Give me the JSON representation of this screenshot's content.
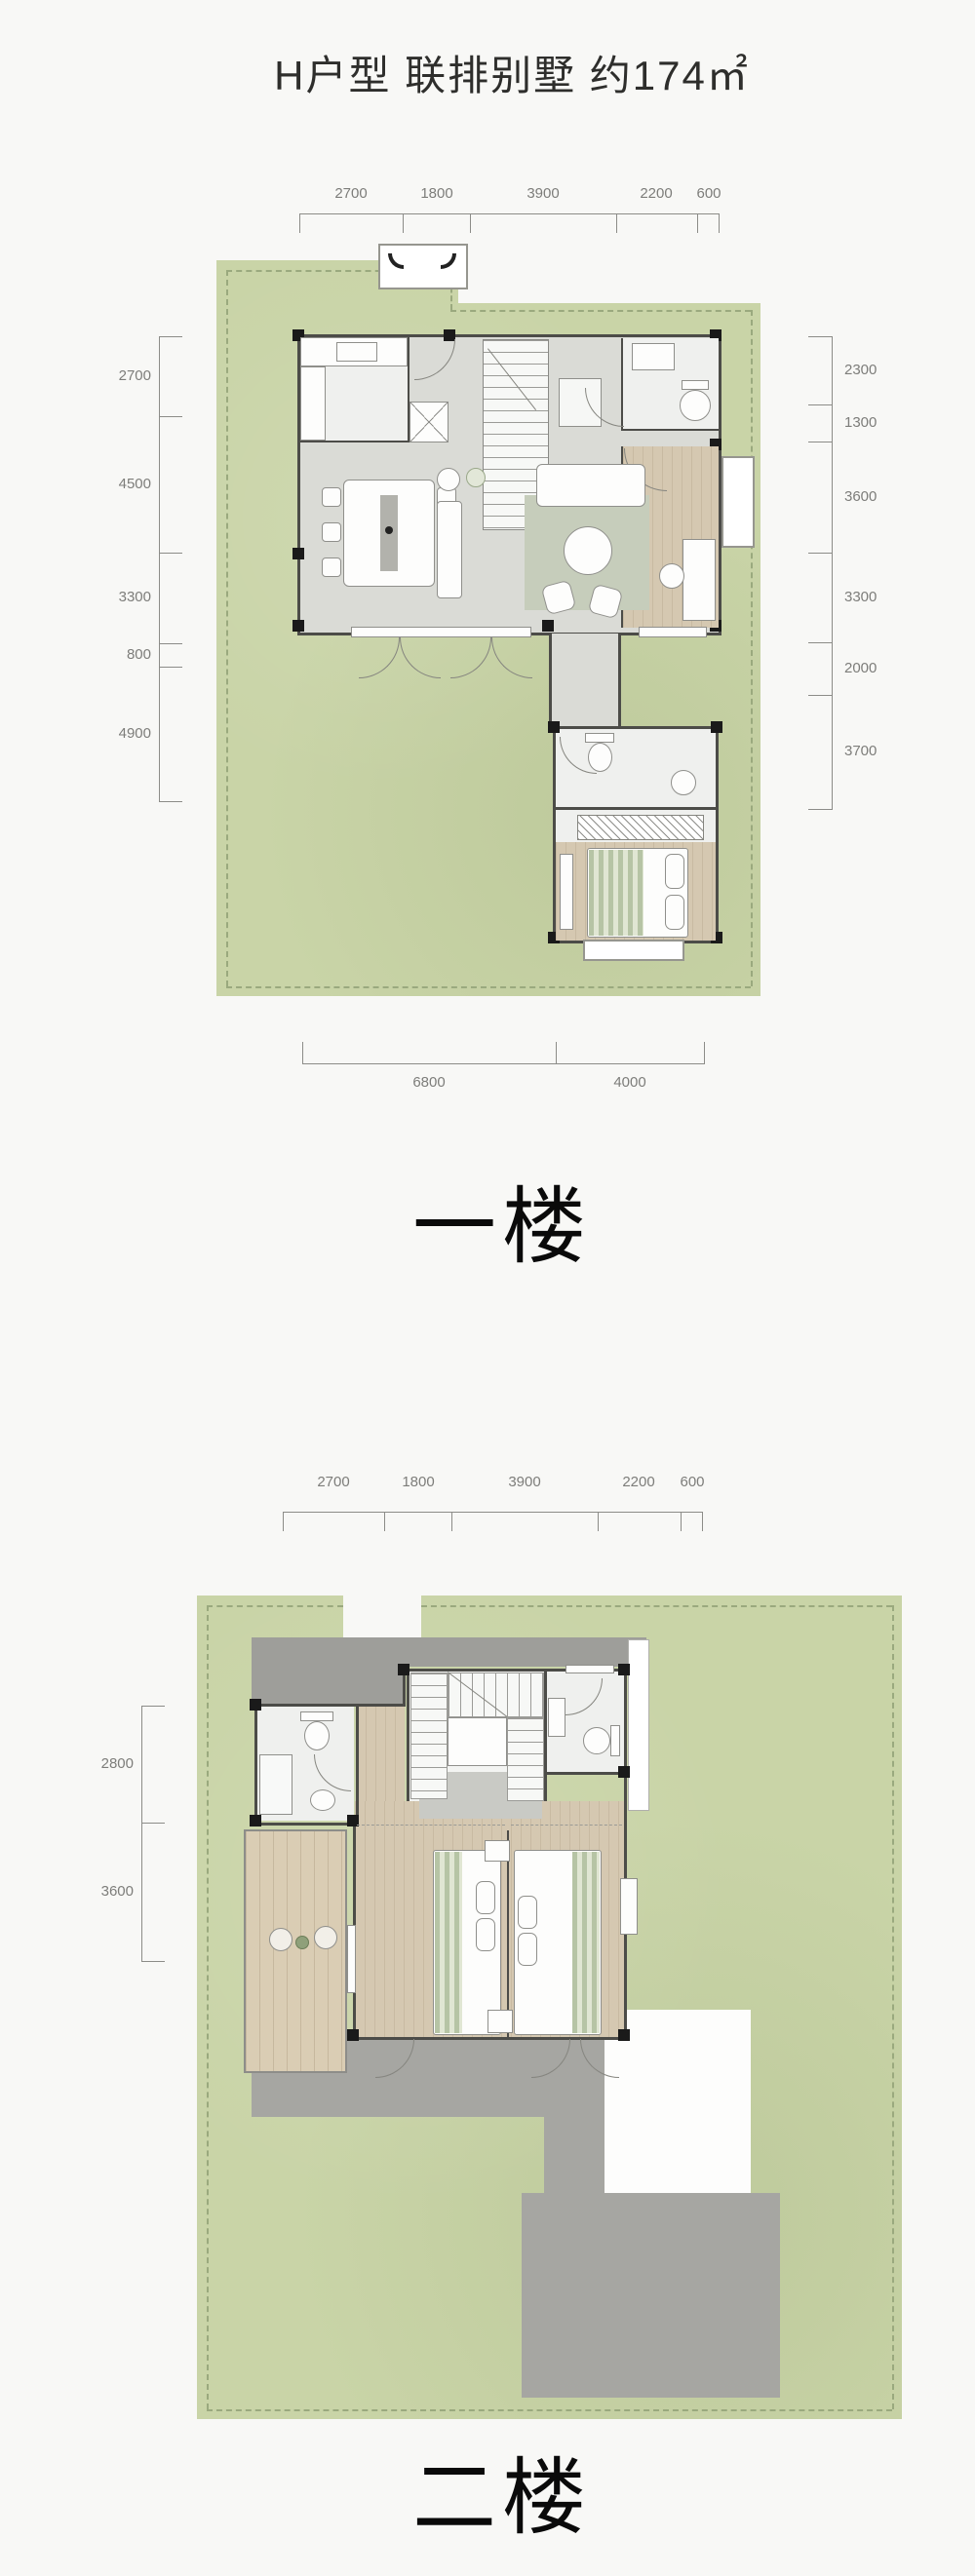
{
  "title": "H户型 联排别墅 约174㎡",
  "floor1": {
    "label": "一楼",
    "dims_top": [
      "2700",
      "1800",
      "3900",
      "2200",
      "600"
    ],
    "dims_left": [
      "2700",
      "4500",
      "3300",
      "800",
      "4900"
    ],
    "dims_right": [
      "2300",
      "1300",
      "3600",
      "3300",
      "2000",
      "3700"
    ],
    "dims_bottom": [
      "6800",
      "4000"
    ]
  },
  "floor2": {
    "label": "二楼",
    "dims_top": [
      "2700",
      "1800",
      "3900",
      "2200",
      "600"
    ],
    "dims_left": [
      "2800",
      "3600"
    ],
    "dims_right": [
      "2300",
      "1300",
      "3600"
    ]
  },
  "colors": {
    "garden_green": "#c9d4a7",
    "garden_border_dash": "#9aa97e",
    "interior_gray": "#dadbd6",
    "wood": "#d5c8b1",
    "wall_dark": "#4c4c48",
    "roof_gray": "#9e9e9a",
    "dim_text": "#7d7d7a"
  }
}
